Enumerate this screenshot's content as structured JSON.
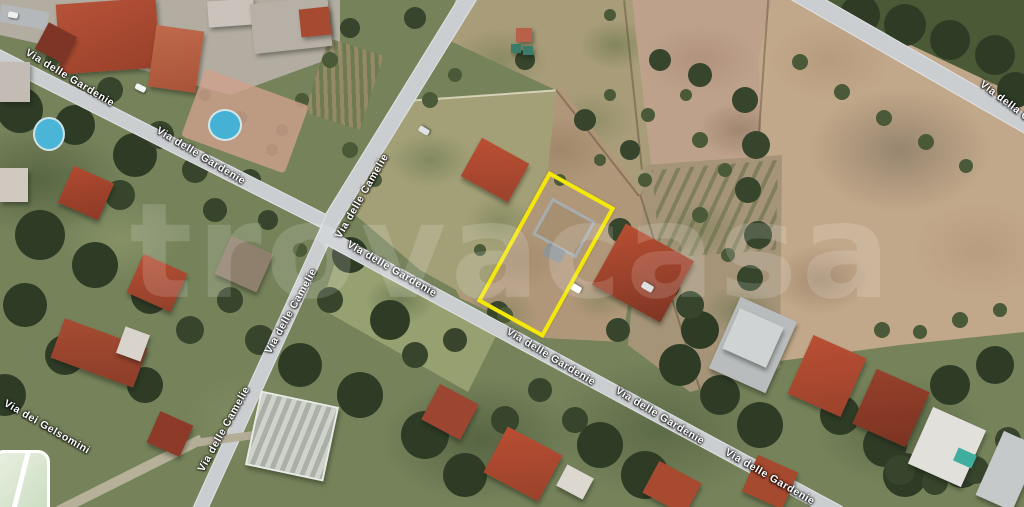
{
  "map": {
    "type": "satellite-aerial-photo",
    "description": "Aerial satellite view of a residential/agricultural area with a land parcel highlighted by a yellow outline",
    "width_px": 1024,
    "height_px": 507
  },
  "watermark": {
    "text": "trovacasa",
    "color": "#ffffff",
    "opacity": 0.15
  },
  "parcel": {
    "outline_color": "#f3e70c",
    "shape": "rotated-rectangle",
    "corners_px": [
      [
        549,
        171
      ],
      [
        617,
        209
      ],
      [
        544,
        334
      ],
      [
        476,
        304
      ]
    ]
  },
  "streets": {
    "names": [
      "Via delle Gardenie",
      "Via delle Camelie",
      "Via dei Gelsomini",
      "Via della C"
    ],
    "labels": [
      {
        "text": "Via delle Gardenie",
        "x": 70,
        "y": 78,
        "angle": 31
      },
      {
        "text": "Via delle Gardenie",
        "x": 201,
        "y": 156,
        "angle": 31
      },
      {
        "text": "Via delle Camelie",
        "x": 362,
        "y": 196,
        "angle": -60
      },
      {
        "text": "Via delle Camelie",
        "x": 291,
        "y": 311,
        "angle": -61
      },
      {
        "text": "Via delle Camelie",
        "x": 224,
        "y": 429,
        "angle": -61
      },
      {
        "text": "Via dei Gelsomini",
        "x": 47,
        "y": 427,
        "angle": 30
      },
      {
        "text": "Via delle Gardenie",
        "x": 392,
        "y": 269,
        "angle": 30
      },
      {
        "text": "Via delle Gardenie",
        "x": 551,
        "y": 357,
        "angle": 31
      },
      {
        "text": "Via delle Gardenie",
        "x": 660,
        "y": 416,
        "angle": 31
      },
      {
        "text": "Via delle Gardenie",
        "x": 770,
        "y": 477,
        "angle": 30
      },
      {
        "text": "Via della C",
        "x": 1005,
        "y": 101,
        "angle": 37
      }
    ]
  },
  "colors": {
    "grass_base": "#75825a",
    "field_tan": "#bfa189",
    "dry_grass": "#a89c79",
    "road_gray": "#cbced0",
    "roof_red": "#ae4a30",
    "pool_blue": "#4ab5d6",
    "highlight_yellow": "#f3e70c",
    "tree_dark": "#2e3c26"
  }
}
